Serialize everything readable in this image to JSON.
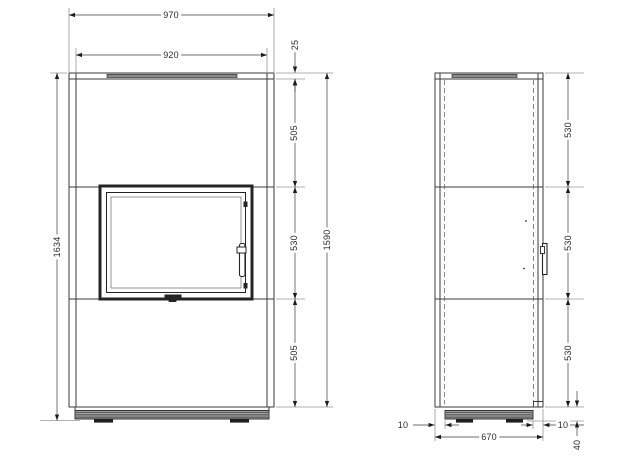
{
  "drawing": {
    "front_view": {
      "dimensions": {
        "overall_width": "970",
        "inner_width": "920",
        "top_plate": "25",
        "upper_section": "505",
        "door_section": "530",
        "lower_section": "505",
        "body_height": "1590",
        "overall_height": "1634"
      }
    },
    "side_view": {
      "dimensions": {
        "section_top": "530",
        "section_middle": "530",
        "section_bottom": "530",
        "base_inset_left": "10",
        "depth": "670",
        "base_inset_right": "10",
        "base_height": "40"
      }
    },
    "line_color": "#3a3a3a",
    "fill_dark": "#1f1f1f",
    "fill_gray": "#9a9a9a"
  }
}
